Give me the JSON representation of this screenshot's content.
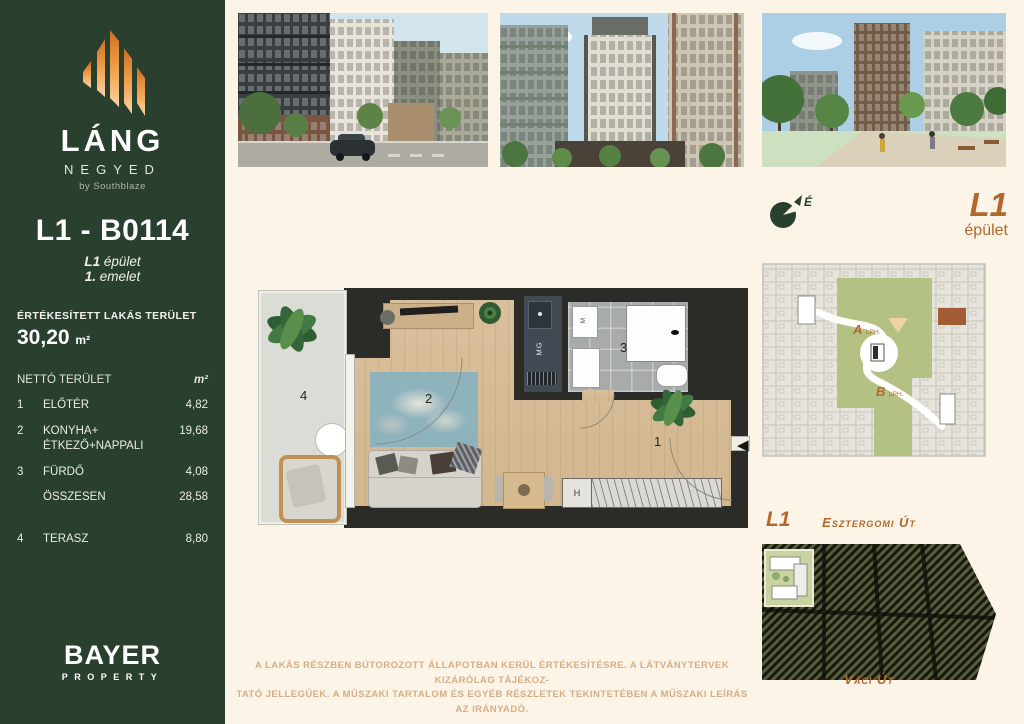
{
  "colors": {
    "accent": "#b4672a",
    "sidebar_green": "#2a402f",
    "page_cream": "#fbf4e7",
    "logo_orange": "#ef9a44",
    "disclaimer_tan": "#d9ad84",
    "courtyard_green": "#b3c183",
    "highlight_unit_brown": "#a25c33"
  },
  "sidebar": {
    "brand": {
      "title": "LÁNG",
      "subtitle": "NEGYED",
      "byline": "by Southblaze"
    },
    "unit_code": "L1 - B0114",
    "building_line": {
      "bold": "L1",
      "rest": " épület"
    },
    "floor_line": {
      "bold": "1.",
      "rest": " emelet"
    },
    "area_label": "ÉRTÉKESÍTETT LAKÁS TERÜLET",
    "area_value": "30,20",
    "area_unit": "m²",
    "table": {
      "header": "NETTÓ TERÜLET",
      "header_unit": "m²",
      "rows": [
        {
          "num": "1",
          "name": "ELŐTÉR",
          "value": "4,82"
        },
        {
          "num": "2",
          "name": "KONYHA+",
          "name2": "ÉTKEZŐ+NAPPALI",
          "value": "19,68"
        },
        {
          "num": "3",
          "name": "FÜRDŐ",
          "value": "4,08"
        },
        {
          "num": "",
          "name": "ÖSSZESEN",
          "value": "28,58"
        },
        {
          "num": "4",
          "name": "TERASZ",
          "value": "8,80"
        }
      ]
    },
    "agency": {
      "name": "BAYER",
      "type": "PROPERTY"
    }
  },
  "floorplan": {
    "rooms": {
      "entry": "1",
      "living": "2",
      "bath": "3",
      "terrace": "4"
    },
    "labels": {
      "kitchen": "MG",
      "washer": "M",
      "wardrobe": "H"
    },
    "entrance_arrow": "◀"
  },
  "right_panel": {
    "compass": {
      "north": "É"
    },
    "building": {
      "code": "L1",
      "word": "épület"
    },
    "siteplan": {
      "a": "A",
      "a_suffix": "LPH.",
      "b": "B",
      "b_suffix": "LPH."
    },
    "map": {
      "code": "L1",
      "street_top": "Esztergomi Út",
      "street_bottom": "Váci Út"
    }
  },
  "disclaimer": {
    "line1": "A LAKÁS RÉSZBEN BÚTOROZOTT ÁLLAPOTBAN KERÜL ÉRTÉKESÍTÉSRE. A LÁTVÁNYTERVEK KIZÁRÓLAG TÁJÉKOZ-",
    "line2": "TATÓ JELLEGŰEK. A MŰSZAKI TARTALOM ÉS EGYÉB RÉSZLETEK TEKINTETÉBEN A MŰSZAKI LEÍRÁS AZ IRÁNYADÓ."
  }
}
